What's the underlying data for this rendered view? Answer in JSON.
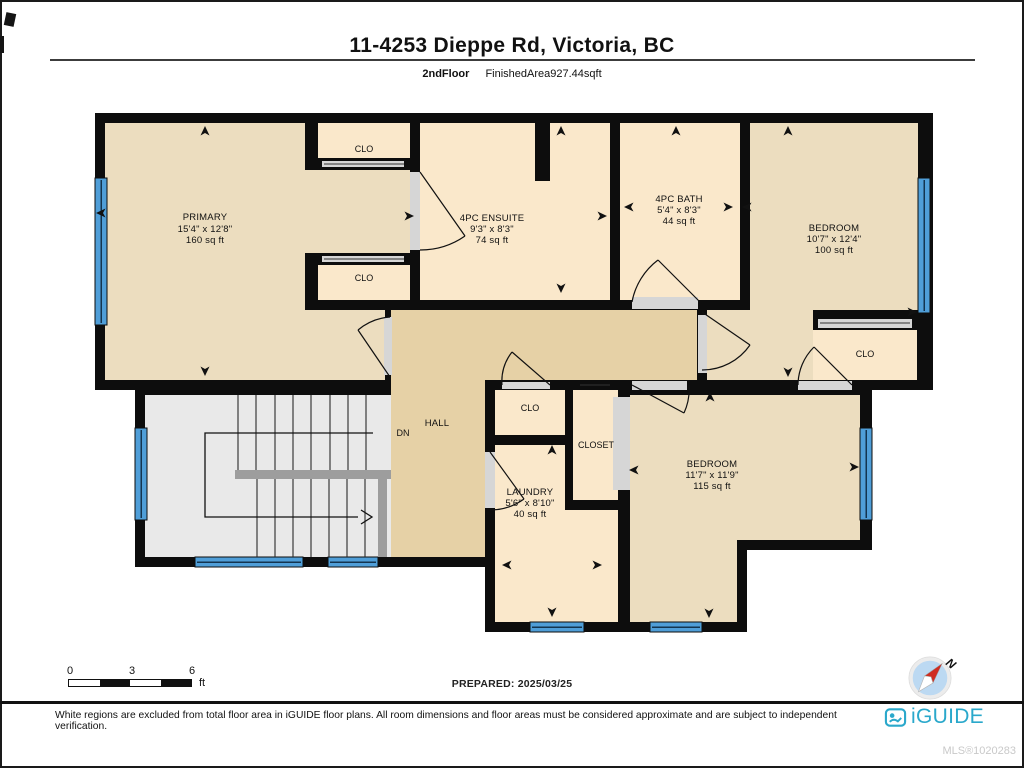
{
  "header": {
    "title": "11-4253 Dieppe Rd, Victoria, BC",
    "floor_label": "2ndFloor",
    "area_label": "FinishedArea927.44sqft"
  },
  "rooms": {
    "primary": {
      "name": "PRIMARY",
      "dims": "15'4\" x 12'8\"",
      "area": "160 sq ft"
    },
    "clo_top": {
      "name": "CLO"
    },
    "clo_mid": {
      "name": "CLO"
    },
    "ensuite": {
      "name": "4PC ENSUITE",
      "dims": "9'3\" x 8'3\"",
      "area": "74 sq ft"
    },
    "bath": {
      "name": "4PC BATH",
      "dims": "5'4\" x 8'3\"",
      "area": "44 sq ft"
    },
    "bedroom_right": {
      "name": "BEDROOM",
      "dims": "10'7\" x 12'4\"",
      "area": "100 sq ft"
    },
    "clo_bedroom": {
      "name": "CLO"
    },
    "hall": {
      "name": "HALL"
    },
    "stairs": {
      "dn": "DN"
    },
    "clo_hall": {
      "name": "CLO"
    },
    "closet": {
      "name": "CLOSET"
    },
    "laundry": {
      "name": "LAUNDRY",
      "dims": "5'6\" x 8'10\"",
      "area": "40 sq ft"
    },
    "bedroom_bottom": {
      "name": "BEDROOM",
      "dims": "11'7\" x 11'9\"",
      "area": "115 sq ft"
    }
  },
  "scale_bar": {
    "tick0": "0",
    "tick1": "3",
    "tick2": "6",
    "unit": "ft"
  },
  "prepared": "PREPARED: 2025/03/25",
  "compass": {
    "label": "N"
  },
  "footer": {
    "disclaimer": "White regions are excluded from total floor area in iGUIDE floor plans. All room dimensions and floor areas must be considered approximate and are subject to independent verification.",
    "brand": "iGUIDE",
    "mls": "MLS®1020283"
  },
  "colors": {
    "wall": "#0d0d0d",
    "room_fill": "#ecddbf",
    "closet_fill": "#fae8cb",
    "hall_fill": "#e6d1a6",
    "stairs_fill": "#e9e9e9",
    "window_blue": "#4f9ed8",
    "door_gap": "#d6d6d6",
    "brand_teal": "#2aa8cb"
  }
}
